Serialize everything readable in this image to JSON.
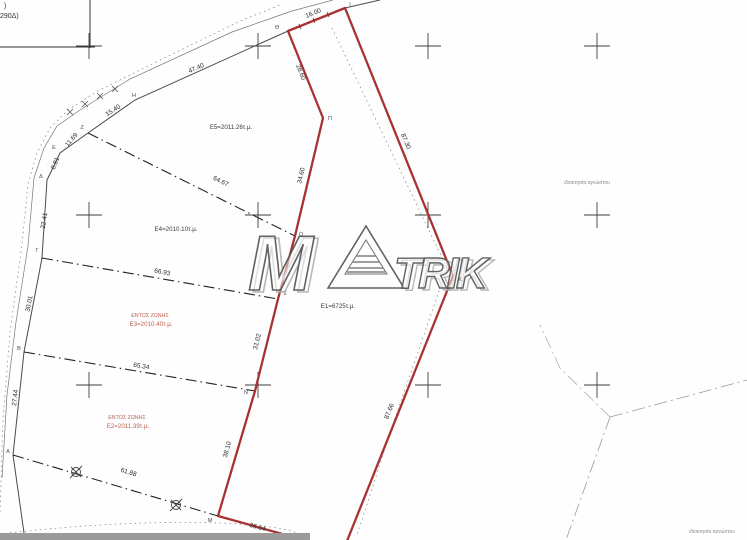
{
  "watermark": {
    "m": "M",
    "trik": "TRIK"
  },
  "accent_colors": {
    "parcel_red": "#a83232",
    "zone_text_red": "#c06055",
    "line_black": "#2b2b2b",
    "faint_gray": "#8a8a8a"
  },
  "texts": [
    {
      "name": "corner-fragment-line1",
      "text": ")",
      "x": 4,
      "y": 8,
      "rot": 0,
      "size": 7,
      "color": "#333333",
      "anchor": "start"
    },
    {
      "name": "corner-fragment-line2",
      "text": "290Δ)",
      "x": 0,
      "y": 18,
      "rot": 0,
      "size": 7,
      "color": "#333333",
      "anchor": "start"
    },
    {
      "name": "dim-47-40",
      "text": "47.40",
      "x": 197,
      "y": 70,
      "rot": -24,
      "size": 6.5,
      "color": "#2b2b2b"
    },
    {
      "name": "dim-15-40",
      "text": "15.40",
      "x": 114,
      "y": 112,
      "rot": -33,
      "size": 6.5,
      "color": "#2b2b2b"
    },
    {
      "name": "dim-11-69",
      "text": "11.69",
      "x": 73,
      "y": 141,
      "rot": -50,
      "size": 6.5,
      "color": "#2b2b2b"
    },
    {
      "name": "dim-8-81",
      "text": "8.81",
      "x": 57,
      "y": 164,
      "rot": -68,
      "size": 6.5,
      "color": "#2b2b2b"
    },
    {
      "name": "dim-22-41",
      "text": "22.41",
      "x": 46,
      "y": 221,
      "rot": -80,
      "size": 6.5,
      "color": "#2b2b2b"
    },
    {
      "name": "dim-30-01",
      "text": "30.01",
      "x": 31,
      "y": 304,
      "rot": -79,
      "size": 6.5,
      "color": "#2b2b2b"
    },
    {
      "name": "dim-27-44",
      "text": "27.44",
      "x": 17,
      "y": 398,
      "rot": -84,
      "size": 6.5,
      "color": "#2b2b2b"
    },
    {
      "name": "dim-64-67",
      "text": "64.67",
      "x": 220,
      "y": 183,
      "rot": 26,
      "size": 6.5,
      "color": "#2b2b2b"
    },
    {
      "name": "dim-66-93",
      "text": "66.93",
      "x": 162,
      "y": 274,
      "rot": 11,
      "size": 6.5,
      "color": "#2b2b2b"
    },
    {
      "name": "dim-65-34",
      "text": "65.34",
      "x": 141,
      "y": 368,
      "rot": 10,
      "size": 6.5,
      "color": "#2b2b2b"
    },
    {
      "name": "dim-61-88",
      "text": "61.88",
      "x": 128,
      "y": 474,
      "rot": 17,
      "size": 6.5,
      "color": "#2b2b2b"
    },
    {
      "name": "dim-16-00",
      "text": "16.00",
      "x": 314,
      "y": 15,
      "rot": -23,
      "size": 6.5,
      "color": "#2b2b2b"
    },
    {
      "name": "dim-28-60",
      "text": "28.60",
      "x": 299,
      "y": 73,
      "rot": 68,
      "size": 6.5,
      "color": "#2b2b2b"
    },
    {
      "name": "dim-34-60",
      "text": "34.60",
      "x": 303,
      "y": 176,
      "rot": -77,
      "size": 6.5,
      "color": "#2b2b2b"
    },
    {
      "name": "dim-31-02",
      "text": "31.02",
      "x": 259,
      "y": 342,
      "rot": -76,
      "size": 6.5,
      "color": "#2b2b2b"
    },
    {
      "name": "dim-38-10",
      "text": "38.10",
      "x": 229,
      "y": 450,
      "rot": -74,
      "size": 6.5,
      "color": "#2b2b2b"
    },
    {
      "name": "dim-36-64",
      "text": "36.64",
      "x": 257,
      "y": 529,
      "rot": 16,
      "size": 6.5,
      "color": "#2b2b2b"
    },
    {
      "name": "dim-87-30",
      "text": "87.30",
      "x": 404,
      "y": 142,
      "rot": 68,
      "size": 6.5,
      "color": "#2b2b2b"
    },
    {
      "name": "dim-87-66",
      "text": "87.66",
      "x": 391,
      "y": 412,
      "rot": -68,
      "size": 6.5,
      "color": "#2b2b2b"
    },
    {
      "name": "point-A",
      "text": "Α",
      "x": 8,
      "y": 453,
      "rot": 0,
      "size": 5.5,
      "color": "#4a4a4a"
    },
    {
      "name": "point-B",
      "text": "Β",
      "x": 19,
      "y": 350,
      "rot": 0,
      "size": 5.5,
      "color": "#4a4a4a"
    },
    {
      "name": "point-G",
      "text": "Γ",
      "x": 37,
      "y": 252,
      "rot": 0,
      "size": 5.5,
      "color": "#4a4a4a"
    },
    {
      "name": "point-D",
      "text": "Δ",
      "x": 41,
      "y": 178,
      "rot": 0,
      "size": 5.5,
      "color": "#4a4a4a"
    },
    {
      "name": "point-E",
      "text": "Ε",
      "x": 54,
      "y": 149,
      "rot": 0,
      "size": 5.5,
      "color": "#4a4a4a"
    },
    {
      "name": "point-Z",
      "text": "Ζ",
      "x": 82,
      "y": 129,
      "rot": 0,
      "size": 5.5,
      "color": "#4a4a4a"
    },
    {
      "name": "point-H",
      "text": "Η",
      "x": 134,
      "y": 97,
      "rot": 0,
      "size": 5.5,
      "color": "#4a4a4a"
    },
    {
      "name": "point-Th",
      "text": "Θ",
      "x": 277,
      "y": 29,
      "rot": 0,
      "size": 5.5,
      "color": "#4a4a4a"
    },
    {
      "name": "point-I",
      "text": "Ι",
      "x": 350,
      "y": 6,
      "rot": 0,
      "size": 5.5,
      "color": "#4a4a4a"
    },
    {
      "name": "point-K",
      "text": "Κ",
      "x": 460,
      "y": 281,
      "rot": 0,
      "size": 5.5,
      "color": "#4a4a4a"
    },
    {
      "name": "point-M",
      "text": "Μ",
      "x": 210,
      "y": 522,
      "rot": 0,
      "size": 5.5,
      "color": "#4a4a4a"
    },
    {
      "name": "point-N",
      "text": "Ν",
      "x": 246,
      "y": 394,
      "rot": 0,
      "size": 5.5,
      "color": "#4a4a4a"
    },
    {
      "name": "point-Xi",
      "text": "Ξ",
      "x": 285,
      "y": 295,
      "rot": 0,
      "size": 5.5,
      "color": "#4a4a4a"
    },
    {
      "name": "point-O",
      "text": "Ο",
      "x": 301,
      "y": 236,
      "rot": 0,
      "size": 5.5,
      "color": "#4a4a4a"
    },
    {
      "name": "point-Pi",
      "text": "Π",
      "x": 330,
      "y": 120,
      "rot": 0,
      "size": 5.5,
      "color": "#4a4a4a"
    },
    {
      "name": "area-label-e5",
      "text": "Ε5=2011.26τ.μ.",
      "x": 231,
      "y": 129,
      "rot": 0,
      "size": 6.2,
      "color": "#3a3a3a"
    },
    {
      "name": "area-label-e4",
      "text": "Ε4=2010.10τ.μ.",
      "x": 176,
      "y": 231,
      "rot": 0,
      "size": 6.2,
      "color": "#3a3a3a"
    },
    {
      "name": "area-label-e1",
      "text": "Ε1=6725τ.μ.",
      "x": 338,
      "y": 308,
      "rot": 0,
      "size": 6.2,
      "color": "#3a3a3a"
    },
    {
      "name": "zone-label-e3-line1",
      "text": "ΕΝΤΟΣ ΖΩΝΗΣ",
      "x": 150,
      "y": 317,
      "rot": 0,
      "size": 5.3,
      "color": "#c06055"
    },
    {
      "name": "zone-label-e3-line2",
      "text": "Ε3=2010.40τ.μ.",
      "x": 151,
      "y": 326,
      "rot": 0,
      "size": 6.2,
      "color": "#c06055"
    },
    {
      "name": "zone-label-e2-line1",
      "text": "ΕΝΤΟΣ ΖΩΝΗΣ",
      "x": 127,
      "y": 419,
      "rot": 0,
      "size": 5.3,
      "color": "#c06055"
    },
    {
      "name": "zone-label-e2-line2",
      "text": "Ε2=2011.39τ.μ.",
      "x": 128,
      "y": 428,
      "rot": 0,
      "size": 6.2,
      "color": "#c06055"
    },
    {
      "name": "owner-note-upper",
      "text": "ιδιοκτησία αγνώστου",
      "x": 587,
      "y": 184,
      "rot": 0,
      "size": 5,
      "color": "#8a8a8a"
    },
    {
      "name": "owner-note-lower",
      "text": "ιδιοκτησία αγνώστου",
      "x": 712,
      "y": 533,
      "rot": 0,
      "size": 5,
      "color": "#8a8a8a"
    }
  ]
}
